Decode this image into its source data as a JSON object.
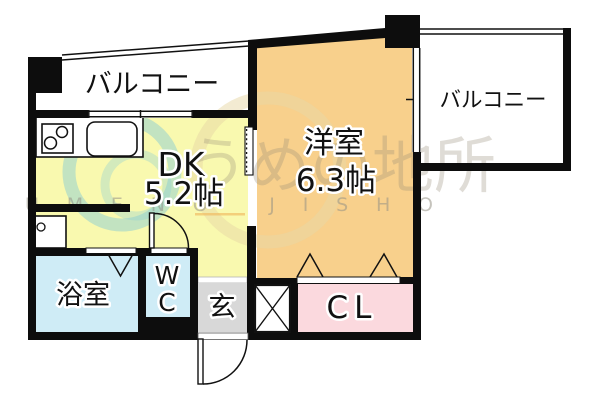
{
  "plan_title": "1DK apartment floor plan",
  "rooms": {
    "balcony_left": {
      "label": "バルコニー"
    },
    "balcony_right": {
      "label": "バルコニー"
    },
    "dining_kitchen": {
      "label": "DK",
      "size": "5.2帖"
    },
    "western_room": {
      "label": "洋室",
      "size": "6.3帖"
    },
    "bathroom": {
      "label": "浴室"
    },
    "toilet": {
      "line1": "W",
      "line2": "C"
    },
    "entrance": {
      "label": "玄"
    },
    "closet": {
      "label": "CL"
    }
  },
  "watermark": {
    "jp": "うめの地所",
    "en": "UMENO JISHO"
  },
  "colors": {
    "dk_floor": "#f9f9af",
    "western_room_floor": "#f8d08c",
    "wet_area_floor": "#cfecf6",
    "entrance_floor": "#d8d8d8",
    "closet_floor": "#fbd9de",
    "wall": "#0d0d0d",
    "watermark_cyan": "#8cc9d3",
    "watermark_tan": "#e8d8a5",
    "watermark_underline": "#f0b95f"
  }
}
